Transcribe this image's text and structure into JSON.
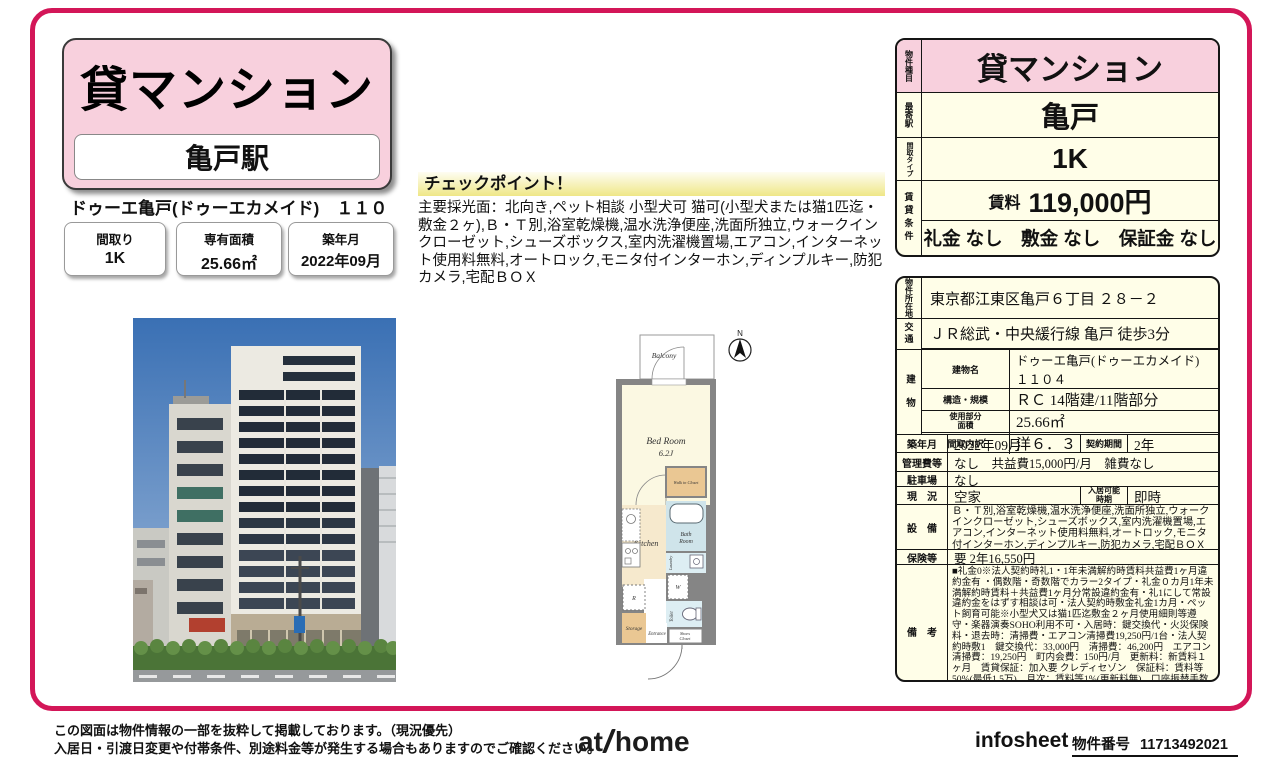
{
  "colors": {
    "accent": "#d31658",
    "pink": "#f8d0dd",
    "cream": "#fffee8",
    "checkpoint_yellow": "#efe787"
  },
  "header": {
    "property_type": "貸マンション",
    "station": "亀戸駅",
    "building_title": "ドゥーエ亀戸(ドゥーエカメイド)　１１０４",
    "badges": [
      {
        "label": "間取り",
        "value": "1K"
      },
      {
        "label": "専有面積",
        "value": "25.66㎡"
      },
      {
        "label": "築年月",
        "value": "2022年09月"
      }
    ]
  },
  "checkpoint": {
    "title": "チェックポイント！",
    "text": "主要採光面：北向き,ペット相談 小型犬可 猫可(小型犬または猫1匹迄・敷金２ヶ),Ｂ・Ｔ別,浴室乾燥機,温水洗浄便座,洗面所独立,ウォークインクローゼット,シューズボックス,室内洗濯機置場,エアコン,インターネット使用料無料,オートロック,モニタ付インターホン,ディンプルキー,防犯カメラ,宅配ＢＯＸ"
  },
  "summary": {
    "property_type_label": "物件種目",
    "property_type": "貸マンション",
    "station_label": "最寄駅",
    "station": "亀戸",
    "layout_label": "間取タイプ",
    "layout": "1K",
    "conditions_label": "賃貸条件",
    "rent_label": "賃料",
    "rent": "119,000円",
    "fees": "礼金 なし　敷金 なし　保証金 なし"
  },
  "details": {
    "address_label": "物件所在地",
    "address": "東京都江東区亀戸６丁目 ２８－２",
    "access_label": "交通",
    "access": "ＪＲ総武・中央緩行線 亀戸 徒歩3分",
    "building_label": "建物",
    "building_name_label": "建物名",
    "building_name": "ドゥーエ亀戸(ドゥーエカメイド)　１１０４",
    "structure_label": "構造・規模",
    "structure": "ＲＣ 14階建/11階部分",
    "area_label": "使用部分面積",
    "area": "25.66㎡",
    "layout_detail_label": "間取内訳",
    "layout_detail": "洋６．３",
    "built_label": "築年月",
    "built": "2022年09月",
    "contract_label": "契約期間",
    "contract": "2年",
    "management_label": "管理費等",
    "management": "なし　共益費15,000円/月　雑費なし",
    "parking_label": "駐車場",
    "parking": "なし",
    "status_label": "現　況",
    "status": "空家",
    "move_in_label": "入居可能時期",
    "move_in": "即時",
    "equipment_label": "設　備",
    "equipment": "Ｂ・Ｔ別,浴室乾燥機,温水洗浄便座,洗面所独立,ウォークインクローゼット,シューズボックス,室内洗濯機置場,エアコン,インターネット使用料無料,オートロック,モニタ付インターホン,ディンプルキー,防犯カメラ,宅配ＢＯＸ",
    "insurance_label": "保険等",
    "insurance": "要 2年16,550円",
    "notes_label": "備　考",
    "notes": "■礼金0※法人契約時礼1・1年未満解約時賃料共益費1ヶ月違約金有 ・偶数階・奇数階でカラー2タイプ・礼金０カ月1年未満解約時賃料＋共益費1ヶ月分常設違約金有・礼1にして常設違約金をはずす相談は可・法人契約時敷金礼金1カ月・ペット飼育可能※小型犬又は猫1匹迄敷金２ヶ月使用細則等遵守・楽器演奏SOHO利用不可・入居時：鍵交換代・火災保険料・退去時：清掃費・エアコン清掃費19,250円/1台・法人契約時敷1　鍵交換代：33,000円　清掃費：46,200円　エアコン清掃費：19,250円　町内会費：150円/月　更新料：新賃料１ヶ月　賃貸保証：加入要 クレディセゾン　保証料：賃料等50%(最低1.5万)、月次：賃料等1%(更新料無)、口座振替手数料借主負担"
  },
  "floorplan": {
    "compass": "N",
    "balcony": "Balcony",
    "bedroom": "Bed Room",
    "bedroom_size": "6.2J",
    "walk_in_closet": "Walk in Closet",
    "kitchen": "Kitchen",
    "bath_1": "Bath",
    "bath_2": "Room",
    "laundry": "Laundry",
    "washer": "W",
    "fridge": "R",
    "toilet": "Toilet",
    "storage": "Storage",
    "entrance": "Entrance",
    "shoes_1": "Shoes",
    "shoes_2": "Closet"
  },
  "footer": {
    "disclaimer1": "この図面は物件情報の一部を抜粋して掲載しております。（現況優先）",
    "disclaimer2": "入居日・引渡日変更や付帯条件、別途料金等が発生する場合もありますのでご確認ください。",
    "logo_at": "at",
    "logo_home": "home",
    "infosheet": "infosheet",
    "property_no_label": "物件番号",
    "property_no": "11713492021"
  }
}
